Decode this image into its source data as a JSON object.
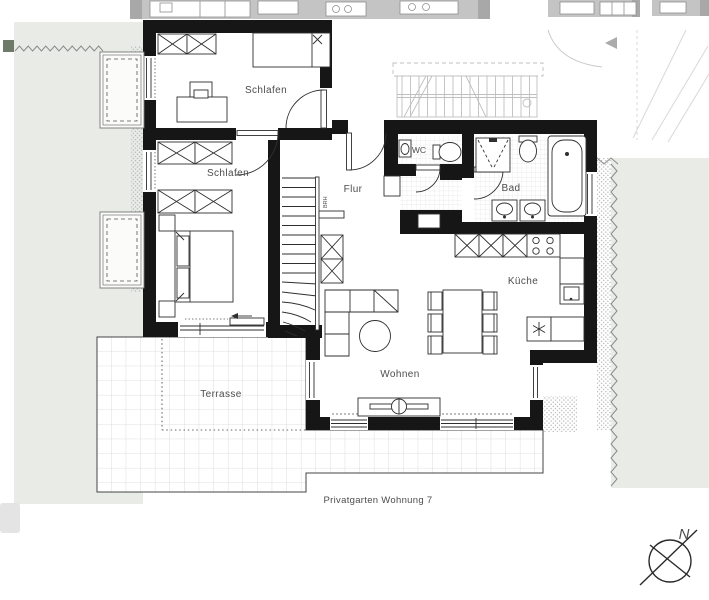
{
  "floor_plan": {
    "room_labels": {
      "schlafen1": "Schlafen",
      "schlafen2": "Schlafen",
      "flur": "Flur",
      "wc": "WC",
      "bad": "Bad",
      "kueche": "Küche",
      "wohnen": "Wohnen",
      "terrasse": "Terrasse"
    },
    "garden_caption": "Privatgarten Wohnung 7",
    "stair_annotation": "BRH",
    "compass": {
      "north_label": "N"
    },
    "colors": {
      "wall": "#161616",
      "garden_green": "#e9ece6",
      "neighbor_gray": "#c4c4c4",
      "tile_line": "#d6d6d6",
      "label_gray": "#4d4d4d"
    }
  }
}
